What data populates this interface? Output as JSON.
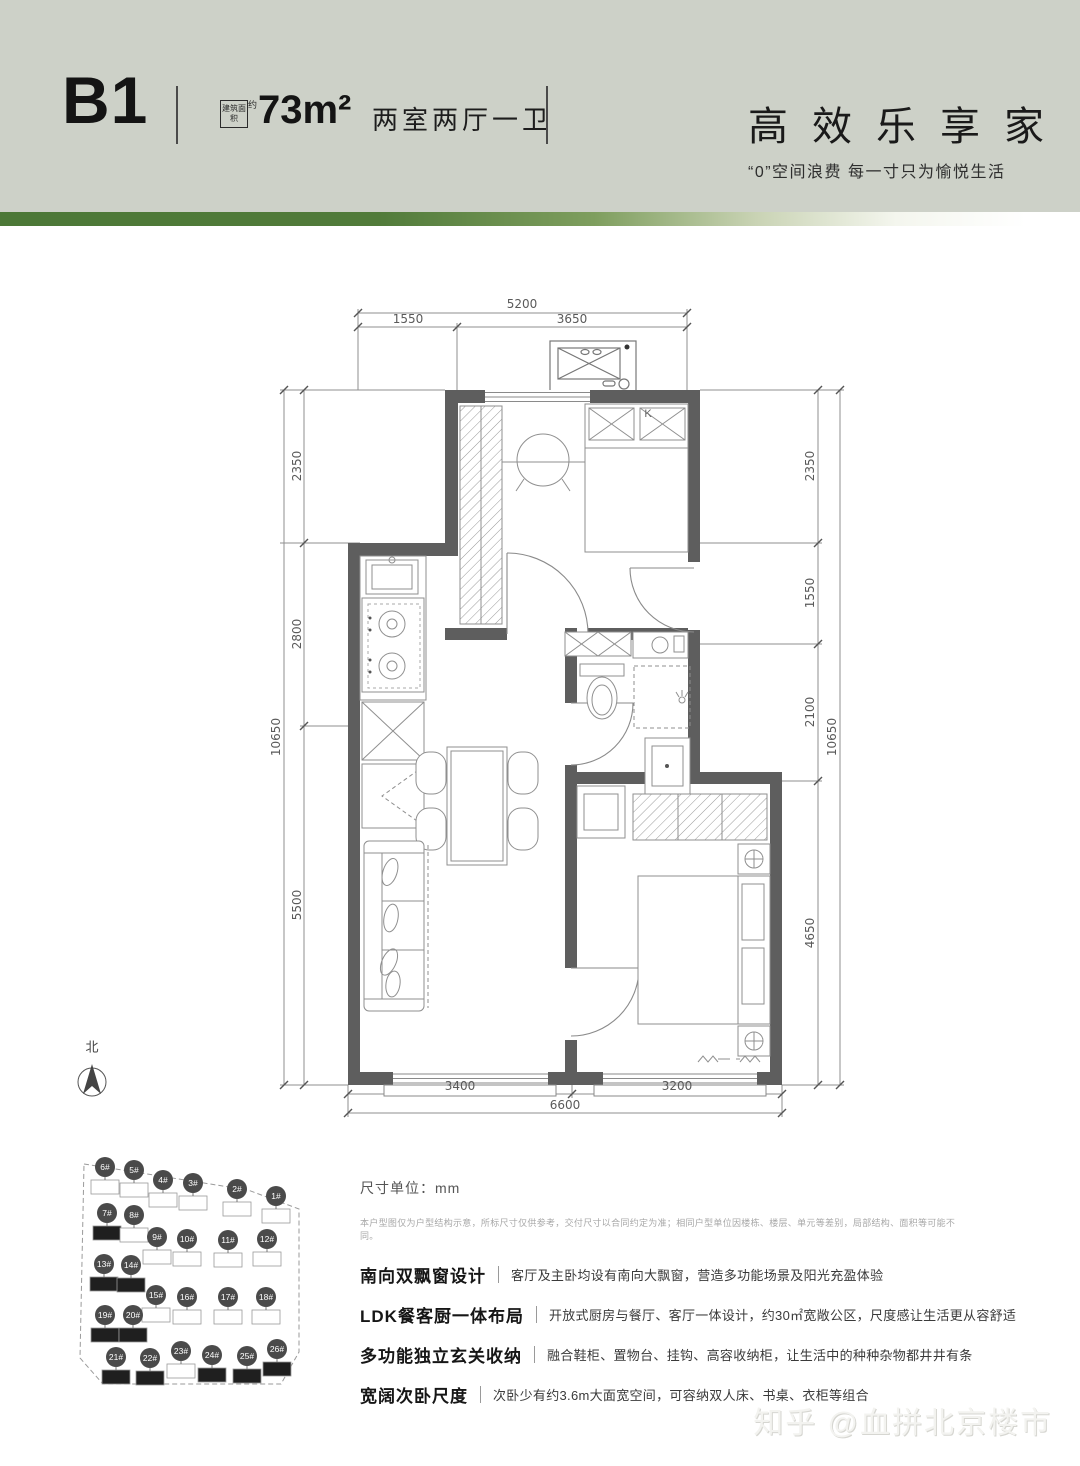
{
  "header": {
    "unit_code": "B1",
    "area_tag": "建筑面积",
    "area_tag_suffix": "约",
    "area_value": "73m²",
    "layout_text": "两室两厅一卫",
    "slogan": "高效乐享家",
    "slogan_sub": "“0”空间浪费 每一寸只为愉悦生活"
  },
  "colors": {
    "header_bg": "#cdd1c8",
    "accent_green": "#4c7837",
    "wall": "#5e5e5e",
    "text_dark": "#1a1a1a",
    "dim_text": "#5a5a5a"
  },
  "floor_plan": {
    "north_label": "北",
    "ac_label": "K",
    "dims": {
      "top": {
        "total": "5200",
        "seg": [
          "1550",
          "3650"
        ]
      },
      "left": {
        "total": "10650",
        "seg": [
          "2350",
          "2800",
          "5500"
        ]
      },
      "right": {
        "total": "10650",
        "seg": [
          "2350",
          "1550",
          "2100",
          "4650"
        ]
      },
      "bottom": {
        "total": "6600",
        "seg": [
          "3400",
          "3200"
        ]
      }
    }
  },
  "site_plan": {
    "buildings": [
      {
        "label": "6#",
        "x": 105,
        "y": 1167,
        "dark": false
      },
      {
        "label": "5#",
        "x": 134,
        "y": 1170,
        "dark": false
      },
      {
        "label": "4#",
        "x": 163,
        "y": 1180,
        "dark": false
      },
      {
        "label": "3#",
        "x": 193,
        "y": 1183,
        "dark": false
      },
      {
        "label": "2#",
        "x": 237,
        "y": 1189,
        "dark": false
      },
      {
        "label": "1#",
        "x": 276,
        "y": 1196,
        "dark": false
      },
      {
        "label": "7#",
        "x": 107,
        "y": 1213,
        "dark": true
      },
      {
        "label": "8#",
        "x": 134,
        "y": 1215,
        "dark": false
      },
      {
        "label": "9#",
        "x": 157,
        "y": 1237,
        "dark": false
      },
      {
        "label": "10#",
        "x": 187,
        "y": 1239,
        "dark": false
      },
      {
        "label": "11#",
        "x": 228,
        "y": 1240,
        "dark": false
      },
      {
        "label": "12#",
        "x": 267,
        "y": 1239,
        "dark": false
      },
      {
        "label": "13#",
        "x": 104,
        "y": 1264,
        "dark": true
      },
      {
        "label": "14#",
        "x": 131,
        "y": 1265,
        "dark": true
      },
      {
        "label": "15#",
        "x": 156,
        "y": 1295,
        "dark": false
      },
      {
        "label": "16#",
        "x": 187,
        "y": 1297,
        "dark": false
      },
      {
        "label": "17#",
        "x": 228,
        "y": 1297,
        "dark": false
      },
      {
        "label": "18#",
        "x": 266,
        "y": 1297,
        "dark": false
      },
      {
        "label": "19#",
        "x": 105,
        "y": 1315,
        "dark": true
      },
      {
        "label": "20#",
        "x": 133,
        "y": 1315,
        "dark": true
      },
      {
        "label": "21#",
        "x": 116,
        "y": 1357,
        "dark": true
      },
      {
        "label": "22#",
        "x": 150,
        "y": 1358,
        "dark": true
      },
      {
        "label": "23#",
        "x": 181,
        "y": 1351,
        "dark": false
      },
      {
        "label": "24#",
        "x": 212,
        "y": 1355,
        "dark": true
      },
      {
        "label": "25#",
        "x": 247,
        "y": 1356,
        "dark": true
      },
      {
        "label": "26#",
        "x": 277,
        "y": 1349,
        "dark": true
      }
    ]
  },
  "notes": {
    "unit_note": "尺寸单位：mm",
    "disclaimer": "本户型图仅为户型结构示意，所标尺寸仅供参考，交付尺寸以合同约定为准；相同户型单位因楼栋、楼层、单元等差别，局部结构、面积等可能不同。"
  },
  "features": [
    {
      "title": "南向双飘窗设计",
      "desc": "客厅及主卧均设有南向大飘窗，营造多功能场景及阳光充盈体验"
    },
    {
      "title": "LDK餐客厨一体布局",
      "desc": "开放式厨房与餐厅、客厅一体设计，约30㎡宽敞公区，尺度感让生活更从容舒适"
    },
    {
      "title": "多功能独立玄关收纳",
      "desc": "融合鞋柜、置物台、挂钩、高容收纳柜，让生活中的种种杂物都井井有条"
    },
    {
      "title": "宽阔次卧尺度",
      "desc": "次卧少有约3.6m大面宽空间，可容纳双人床、书桌、衣柜等组合"
    }
  ],
  "watermark": "知乎 @血拼北京楼市"
}
